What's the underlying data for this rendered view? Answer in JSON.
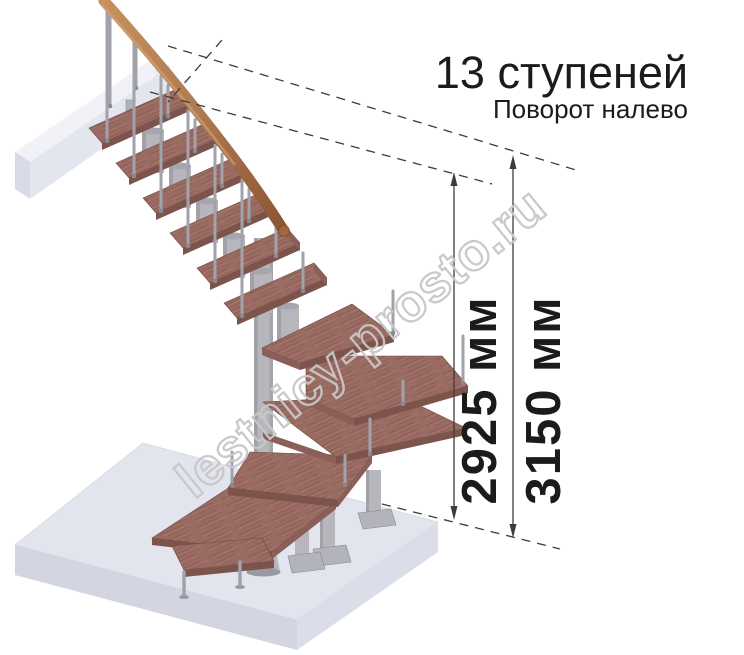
{
  "title": {
    "steps_count": "13 ступеней",
    "turn_direction": "Поворот налево"
  },
  "dimensions": {
    "inner": {
      "label": "2925 мм",
      "value": "2925",
      "unit": "мм"
    },
    "outer": {
      "label": "3150 мм",
      "value": "3150",
      "unit": "мм"
    }
  },
  "watermark": {
    "text": "lestnicy-prosto.ru"
  },
  "colors": {
    "background": "#ffffff",
    "text": "#1b1b1b",
    "dim_line": "#3c3c3c",
    "watermark": "#c8c8c8",
    "tread_top": "#9a6b62",
    "tread_front": "#7c544c",
    "tread_edge": "#8a5f57",
    "wood_streak": "#81564c",
    "handrail": "#b07a52",
    "handrail_dark": "#8a5531",
    "metal": "#b6b6bc",
    "metal_dark": "#8c8c94",
    "baluster": "#a2a2aa",
    "slab_top": "#f0f2f7",
    "slab_front": "#e3e6ef",
    "slab_side": "#d8dbe6",
    "platform_top": "#e3e5ee",
    "platform_front": "#d3d6e0",
    "platform_side": "#dbdee8"
  }
}
